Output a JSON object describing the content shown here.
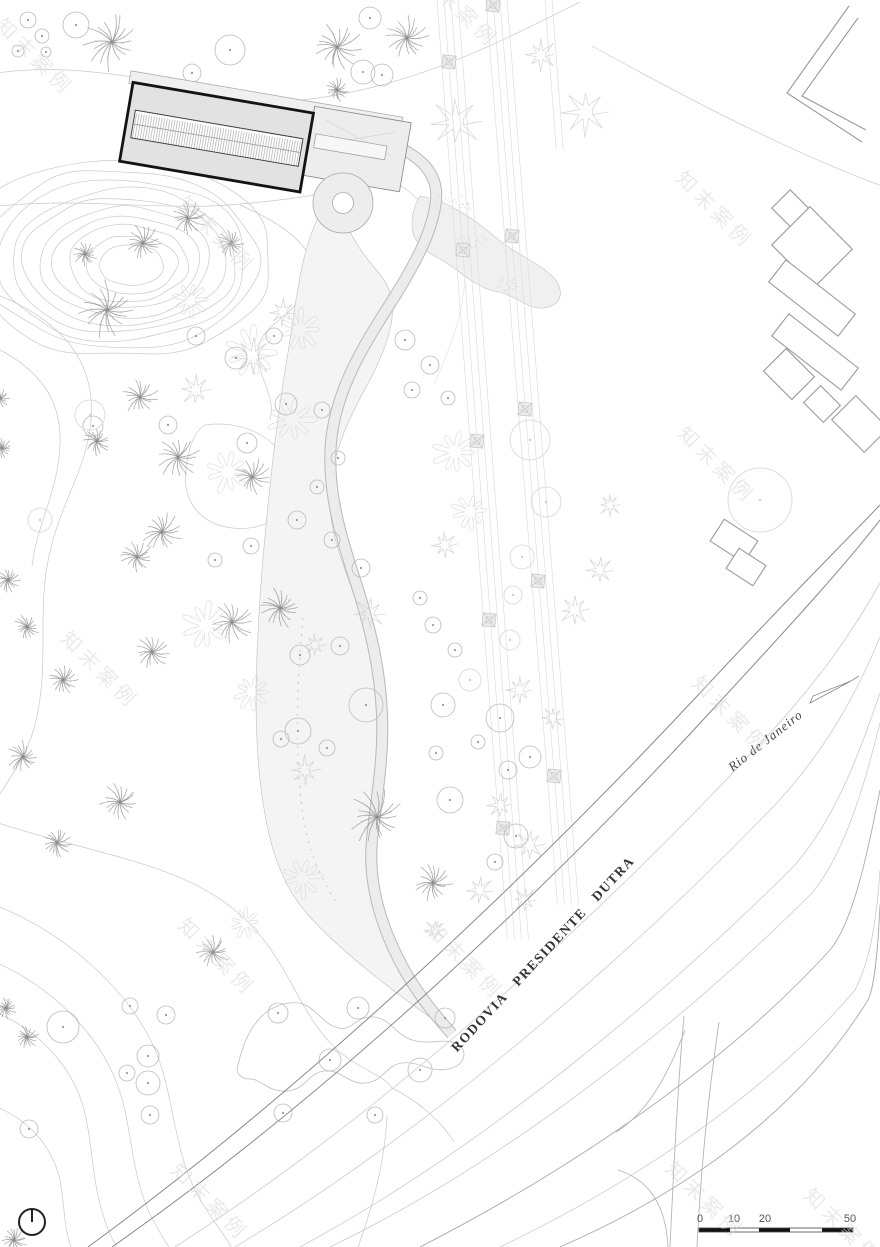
{
  "labels": {
    "highway": "RODOVIA  PRESIDENTE  DUTRA",
    "direction": "Rio de Janeiro"
  },
  "scale_bar": {
    "ticks": [
      {
        "label": "0",
        "x": 700
      },
      {
        "label": "10",
        "x": 734
      },
      {
        "label": "20",
        "x": 765
      },
      {
        "label": "50",
        "x": 850
      }
    ],
    "bar": {
      "x1": 699,
      "x2": 853,
      "y": 1228,
      "h": 4
    },
    "segments": [
      [
        699,
        730,
        1
      ],
      [
        730,
        759,
        0
      ],
      [
        759,
        790,
        1
      ],
      [
        790,
        822,
        0
      ],
      [
        822,
        853,
        1
      ]
    ]
  },
  "north_symbol": {
    "cx": 32,
    "cy": 1222,
    "r": 13
  },
  "watermark": {
    "text": "知末案例",
    "color": "#d9d9d9",
    "positions": [
      [
        30,
        62
      ],
      [
        455,
        14
      ],
      [
        212,
        240
      ],
      [
        710,
        215
      ],
      [
        712,
        470
      ],
      [
        95,
        675
      ],
      [
        726,
        720
      ],
      [
        212,
        962
      ],
      [
        460,
        966
      ],
      [
        205,
        1207
      ],
      [
        700,
        1205
      ],
      [
        838,
        1232
      ]
    ]
  },
  "colors": {
    "contour": "#c9c9c9",
    "tree_dark": "#8a8a8a",
    "tree_outline": "#cfcfcf",
    "tree_flower": "#dddddd",
    "tree_circle": "#bbbbbb",
    "tree_circle_light": "#dedede",
    "transmission_line": "#dedede",
    "tower_fill": "#ececec",
    "tower_stroke": "#c4c4c4",
    "building_stroke": "#141414"
  },
  "trees": {
    "palms": [
      [
        112,
        42,
        26
      ],
      [
        337,
        47,
        23
      ],
      [
        407,
        38,
        20
      ],
      [
        337,
        90,
        11
      ],
      [
        188,
        218,
        16
      ],
      [
        143,
        243,
        17
      ],
      [
        231,
        243,
        13
      ],
      [
        85,
        254,
        11
      ],
      [
        107,
        310,
        27
      ],
      [
        140,
        397,
        17
      ],
      [
        97,
        441,
        13
      ],
      [
        178,
        457,
        20
      ],
      [
        252,
        477,
        17
      ],
      [
        162,
        532,
        19
      ],
      [
        137,
        557,
        16
      ],
      [
        8,
        580,
        12
      ],
      [
        27,
        627,
        12
      ],
      [
        232,
        622,
        19
      ],
      [
        152,
        652,
        17
      ],
      [
        63,
        680,
        14
      ],
      [
        280,
        608,
        19
      ],
      [
        23,
        757,
        15
      ],
      [
        120,
        802,
        19
      ],
      [
        57,
        843,
        13
      ],
      [
        377,
        817,
        26
      ],
      [
        433,
        883,
        18
      ],
      [
        213,
        952,
        15
      ],
      [
        6,
        1008,
        10
      ],
      [
        27,
        1037,
        11
      ],
      [
        14,
        1240,
        12
      ],
      [
        2,
        448,
        10
      ],
      [
        0,
        398,
        9
      ]
    ],
    "stars": [
      [
        322,
        158,
        20
      ],
      [
        541,
        55,
        15
      ],
      [
        456,
        122,
        24
      ],
      [
        586,
        112,
        22
      ],
      [
        253,
        357,
        19
      ],
      [
        196,
        390,
        15
      ],
      [
        283,
        312,
        13
      ],
      [
        445,
        545,
        13
      ],
      [
        370,
        613,
        15
      ],
      [
        315,
        645,
        11
      ],
      [
        305,
        770,
        14
      ],
      [
        520,
        690,
        13
      ],
      [
        553,
        718,
        11
      ],
      [
        500,
        805,
        13
      ],
      [
        530,
        845,
        15
      ],
      [
        480,
        890,
        13
      ],
      [
        525,
        900,
        12
      ],
      [
        435,
        930,
        10
      ],
      [
        575,
        610,
        15
      ],
      [
        600,
        570,
        13
      ],
      [
        610,
        505,
        11
      ]
    ],
    "flowers": [
      [
        252,
        352,
        26
      ],
      [
        292,
        420,
        23
      ],
      [
        228,
        472,
        21
      ],
      [
        206,
        626,
        23
      ],
      [
        252,
        692,
        17
      ],
      [
        300,
        330,
        21
      ],
      [
        190,
        300,
        17
      ],
      [
        302,
        878,
        19
      ],
      [
        245,
        923,
        15
      ],
      [
        455,
        452,
        22
      ],
      [
        470,
        512,
        18
      ]
    ],
    "circles": [
      [
        76,
        25,
        13
      ],
      [
        28,
        20,
        8
      ],
      [
        42,
        36,
        7
      ],
      [
        46,
        52,
        5
      ],
      [
        18,
        51,
        6
      ],
      [
        230,
        50,
        15
      ],
      [
        192,
        73,
        9
      ],
      [
        370,
        18,
        11
      ],
      [
        363,
        72,
        12
      ],
      [
        382,
        75,
        11
      ],
      [
        196,
        336,
        9
      ],
      [
        236,
        358,
        11
      ],
      [
        274,
        336,
        8
      ],
      [
        286,
        404,
        11
      ],
      [
        322,
        410,
        8
      ],
      [
        247,
        443,
        10
      ],
      [
        168,
        425,
        9
      ],
      [
        93,
        426,
        10
      ],
      [
        338,
        458,
        7
      ],
      [
        317,
        487,
        7
      ],
      [
        297,
        520,
        9
      ],
      [
        332,
        540,
        8
      ],
      [
        361,
        568,
        9
      ],
      [
        251,
        546,
        8
      ],
      [
        215,
        560,
        7
      ],
      [
        405,
        340,
        10
      ],
      [
        430,
        365,
        9
      ],
      [
        412,
        390,
        8
      ],
      [
        448,
        398,
        7
      ],
      [
        340,
        646,
        9
      ],
      [
        300,
        655,
        10
      ],
      [
        366,
        705,
        17
      ],
      [
        298,
        731,
        13
      ],
      [
        281,
        739,
        8
      ],
      [
        327,
        748,
        8
      ],
      [
        443,
        705,
        12
      ],
      [
        500,
        718,
        14
      ],
      [
        436,
        753,
        7
      ],
      [
        450,
        800,
        13
      ],
      [
        530,
        757,
        11
      ],
      [
        516,
        836,
        12
      ],
      [
        478,
        742,
        7
      ],
      [
        508,
        770,
        9
      ],
      [
        495,
        862,
        8
      ],
      [
        433,
        625,
        8
      ],
      [
        455,
        650,
        7
      ],
      [
        420,
        598,
        7
      ],
      [
        358,
        1008,
        11
      ],
      [
        278,
        1013,
        10
      ],
      [
        330,
        1060,
        11
      ],
      [
        420,
        1070,
        12
      ],
      [
        445,
        1018,
        10
      ],
      [
        283,
        1113,
        9
      ],
      [
        375,
        1115,
        8
      ],
      [
        63,
        1027,
        16
      ],
      [
        130,
        1006,
        8
      ],
      [
        166,
        1015,
        9
      ],
      [
        148,
        1056,
        11
      ],
      [
        127,
        1073,
        8
      ],
      [
        148,
        1083,
        12
      ],
      [
        150,
        1115,
        9
      ],
      [
        29,
        1129,
        9
      ]
    ],
    "light_circles": [
      [
        90,
        415,
        15
      ],
      [
        40,
        520,
        12
      ],
      [
        530,
        440,
        20
      ],
      [
        546,
        502,
        15
      ],
      [
        522,
        557,
        12
      ],
      [
        513,
        595,
        9
      ],
      [
        760,
        500,
        32
      ],
      [
        470,
        680,
        11
      ],
      [
        510,
        640,
        10
      ]
    ],
    "clusters": [
      [
        450,
        205,
        22
      ],
      [
        472,
        242,
        17
      ],
      [
        505,
        285,
        14
      ]
    ]
  },
  "transmission": {
    "set1": {
      "x0": [
        437,
        444,
        451,
        458
      ],
      "slope": 0.075,
      "y1": 0,
      "y2": 940
    },
    "set2": {
      "x0": [
        486,
        493,
        500,
        507
      ],
      "slope": 0.079,
      "y1": 0,
      "y2": 905
    },
    "set3": {
      "x0": [
        545,
        552
      ],
      "slope": 0.075,
      "y1": 0,
      "y2": 150
    },
    "towers": [
      [
        449,
        62
      ],
      [
        463,
        250
      ],
      [
        477,
        441
      ],
      [
        489,
        620
      ],
      [
        503,
        828
      ],
      [
        493,
        5
      ],
      [
        512,
        236
      ],
      [
        525,
        409
      ],
      [
        538,
        581
      ],
      [
        554,
        776
      ]
    ]
  }
}
